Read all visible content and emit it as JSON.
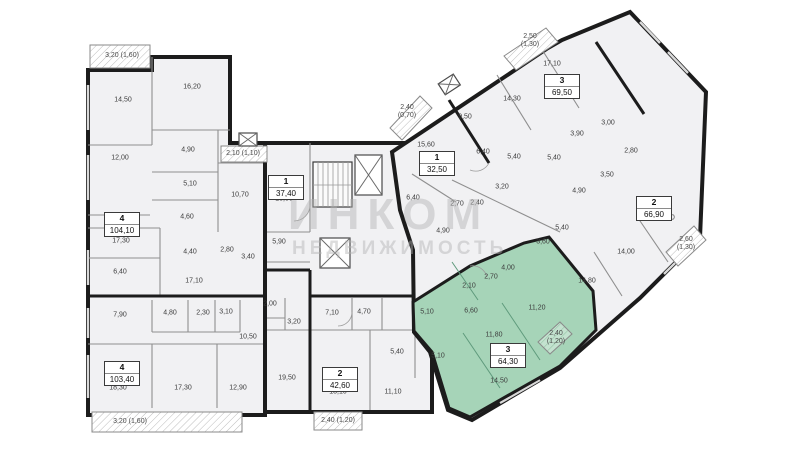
{
  "watermark": {
    "line1": "ИНКОМ",
    "line2": "НЕДВИЖИМОСТЬ"
  },
  "colors": {
    "room_fill": "#f1f1f3",
    "selected_fill": "#a6d4b8",
    "wall": "#1c1c1c",
    "partition": "#8f8f8f",
    "label": "#3c3c3c"
  },
  "apartments": [
    {
      "id": "apt-left-top",
      "type": "4",
      "area": "104,10",
      "selected": false,
      "rooms": [
        {
          "label": "14,50",
          "x": 123,
          "y": 100
        },
        {
          "label": "16,20",
          "x": 192,
          "y": 87
        },
        {
          "label": "12,00",
          "x": 120,
          "y": 158
        },
        {
          "label": "4,90",
          "x": 188,
          "y": 150
        },
        {
          "label": "5,10",
          "x": 190,
          "y": 184
        },
        {
          "label": "4,60",
          "x": 187,
          "y": 217
        },
        {
          "label": "2,80",
          "x": 227,
          "y": 250
        },
        {
          "label": "4,40",
          "x": 190,
          "y": 252
        },
        {
          "label": "17,30",
          "x": 121,
          "y": 241
        },
        {
          "label": "6,40",
          "x": 120,
          "y": 272
        },
        {
          "label": "17,10",
          "x": 194,
          "y": 281
        }
      ],
      "balconies": [
        {
          "label": "3,20 (1,60)",
          "x": 122,
          "y": 56,
          "wide": true
        }
      ]
    },
    {
      "id": "apt-left-bottom",
      "type": "4",
      "area": "103,40",
      "selected": false,
      "rooms": [
        {
          "label": "7,90",
          "x": 120,
          "y": 315
        },
        {
          "label": "4,80",
          "x": 170,
          "y": 313
        },
        {
          "label": "2,30",
          "x": 203,
          "y": 313
        },
        {
          "label": "3,10",
          "x": 226,
          "y": 312
        },
        {
          "label": "2,00",
          "x": 270,
          "y": 304
        },
        {
          "label": "3,20",
          "x": 294,
          "y": 322
        },
        {
          "label": "10,50",
          "x": 248,
          "y": 337
        },
        {
          "label": "19,50",
          "x": 287,
          "y": 378
        },
        {
          "label": "18,30",
          "x": 118,
          "y": 388
        },
        {
          "label": "17,30",
          "x": 183,
          "y": 388
        },
        {
          "label": "12,90",
          "x": 238,
          "y": 388
        }
      ],
      "balconies": [
        {
          "label": "3,20 (1,60)",
          "x": 130,
          "y": 422,
          "wide": true
        }
      ]
    },
    {
      "id": "apt-mid-studio",
      "type": "1",
      "area": "37,40",
      "selected": false,
      "rooms": [
        {
          "label": "13,50",
          "x": 284,
          "y": 199
        },
        {
          "label": "10,70",
          "x": 240,
          "y": 195
        },
        {
          "label": "5,90",
          "x": 279,
          "y": 242
        },
        {
          "label": "3,40",
          "x": 248,
          "y": 257
        }
      ],
      "balconies": [
        {
          "label": "2,10 (1,10)",
          "x": 243,
          "y": 154,
          "wide": true
        }
      ]
    },
    {
      "id": "apt-mid-two",
      "type": "2",
      "area": "42,60",
      "selected": false,
      "rooms": [
        {
          "label": "7,10",
          "x": 332,
          "y": 313
        },
        {
          "label": "4,70",
          "x": 364,
          "y": 312
        },
        {
          "label": "5,40",
          "x": 397,
          "y": 352
        },
        {
          "label": "13,10",
          "x": 338,
          "y": 392
        },
        {
          "label": "11,10",
          "x": 393,
          "y": 392
        }
      ],
      "balconies": [
        {
          "label": "2,40 (1,20)",
          "x": 338,
          "y": 421,
          "wide": true
        }
      ]
    },
    {
      "id": "apt-wing-one",
      "type": "1",
      "area": "32,50",
      "selected": false,
      "rooms": [
        {
          "label": "15,60",
          "x": 426,
          "y": 145
        },
        {
          "label": "6,40",
          "x": 413,
          "y": 198
        },
        {
          "label": "4,90",
          "x": 443,
          "y": 231
        },
        {
          "label": "2,70",
          "x": 457,
          "y": 204
        },
        {
          "label": "2,40",
          "x": 477,
          "y": 203
        },
        {
          "label": "3,20",
          "x": 502,
          "y": 187
        }
      ],
      "balconies": [
        {
          "label": "2,40 (0,70)",
          "x": 407,
          "y": 112,
          "wide": false
        }
      ]
    },
    {
      "id": "apt-wing-three",
      "type": "3",
      "area": "69,50",
      "selected": false,
      "rooms": [
        {
          "label": "17,10",
          "x": 552,
          "y": 64
        },
        {
          "label": "14,30",
          "x": 512,
          "y": 99
        },
        {
          "label": "9,50",
          "x": 465,
          "y": 117
        },
        {
          "label": "6,40",
          "x": 483,
          "y": 152
        },
        {
          "label": "5,40",
          "x": 514,
          "y": 157
        },
        {
          "label": "3,90",
          "x": 577,
          "y": 134
        }
      ],
      "balconies": [
        {
          "label": "2,50 (1,30)",
          "x": 530,
          "y": 41,
          "wide": false
        }
      ]
    },
    {
      "id": "apt-wing-two",
      "type": "2",
      "area": "66,90",
      "selected": false,
      "rooms": [
        {
          "label": "16,80",
          "x": 666,
          "y": 218
        },
        {
          "label": "14,00",
          "x": 626,
          "y": 252
        },
        {
          "label": "14,80",
          "x": 587,
          "y": 281
        },
        {
          "label": "5,40",
          "x": 554,
          "y": 158
        },
        {
          "label": "3,00",
          "x": 608,
          "y": 123
        },
        {
          "label": "4,90",
          "x": 579,
          "y": 191
        },
        {
          "label": "3,50",
          "x": 607,
          "y": 175
        },
        {
          "label": "2,80",
          "x": 631,
          "y": 151
        },
        {
          "label": "5,40",
          "x": 562,
          "y": 228
        },
        {
          "label": "3,60",
          "x": 543,
          "y": 242
        }
      ],
      "balconies": [
        {
          "label": "2,60 (1,30)",
          "x": 686,
          "y": 244,
          "wide": false
        }
      ]
    },
    {
      "id": "apt-wing-green",
      "type": "3",
      "area": "64,30",
      "selected": true,
      "rooms": [
        {
          "label": "14,50",
          "x": 499,
          "y": 381
        },
        {
          "label": "11,80",
          "x": 494,
          "y": 335
        },
        {
          "label": "11,20",
          "x": 537,
          "y": 308
        },
        {
          "label": "6,60",
          "x": 471,
          "y": 311
        },
        {
          "label": "5,10",
          "x": 427,
          "y": 312
        },
        {
          "label": "5,10",
          "x": 438,
          "y": 356
        },
        {
          "label": "2,10",
          "x": 469,
          "y": 286
        },
        {
          "label": "2,70",
          "x": 491,
          "y": 277
        },
        {
          "label": "4,00",
          "x": 508,
          "y": 268
        }
      ],
      "balconies": [
        {
          "label": "2,40 (1,20)",
          "x": 556,
          "y": 338,
          "wide": false
        }
      ]
    }
  ]
}
